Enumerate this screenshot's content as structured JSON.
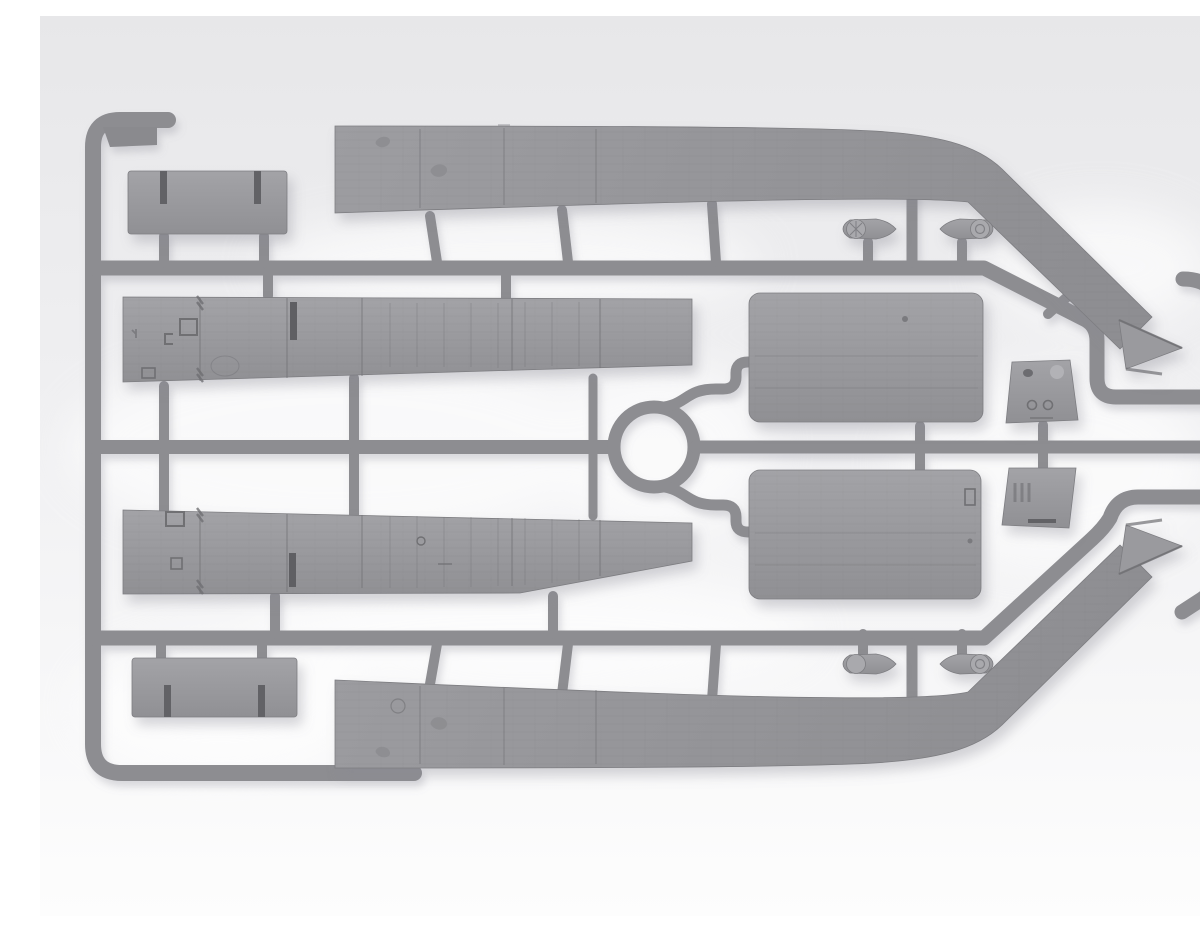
{
  "scene": {
    "description": "3D render of a gray injection-moulded plastic model kit sprue (runner frame with attached parts) photographed on a bright neutral studio background",
    "palette": {
      "bg-top": "#e7e7e9",
      "bg-mid": "#f0f0f2",
      "bg-bottom": "#fdfdfd",
      "runner": "#8d8d91",
      "plastic": "#97979b",
      "plastic-light": "#a5a5a9",
      "plastic-dark": "#7d7d81",
      "plastic-deep": "#6f6f73",
      "halo": "#ffffff",
      "shadow": "#8b8b97"
    },
    "material": "light gray styrene plastic",
    "parts": [
      {
        "id": "deck-panel-upper",
        "label": "long tapered deck panel with angled arrow-tip end (top)"
      },
      {
        "id": "deck-panel-lower",
        "label": "long tapered deck panel with angled arrow-tip end (bottom)"
      },
      {
        "id": "side-panel-upper",
        "label": "sectioned side panel with hatch and rib details (upper middle)"
      },
      {
        "id": "side-panel-lower",
        "label": "sectioned side panel with hatch and rib details (lower middle)"
      },
      {
        "id": "slotted-plate-upper-left",
        "label": "rectangular plate with two slots (upper left)"
      },
      {
        "id": "slotted-plate-lower-left",
        "label": "rectangular plate with two slots (lower left)"
      },
      {
        "id": "canvas-panel-upper",
        "label": "large rounded canvas panel (upper right)"
      },
      {
        "id": "canvas-panel-lower",
        "label": "large rounded canvas panel (lower right)"
      },
      {
        "id": "bulkhead-upper",
        "label": "small trapezoid bulkhead with holes (right, upper)"
      },
      {
        "id": "bulkhead-lower",
        "label": "small trapezoid bulkhead with ribs (right, lower)"
      },
      {
        "id": "cap-housing-top-left",
        "label": "small capped housing (top row, left)"
      },
      {
        "id": "cap-housing-top-right",
        "label": "small capped housing (top row, right)"
      },
      {
        "id": "cap-housing-bottom-left",
        "label": "small capped housing (bottom row, left)"
      },
      {
        "id": "cap-housing-bottom-right",
        "label": "small capped housing (bottom row, right)"
      },
      {
        "id": "sprue-frame",
        "label": "runner frame: left rail with hooks, three cross runners, centre ring, right rail"
      }
    ]
  }
}
